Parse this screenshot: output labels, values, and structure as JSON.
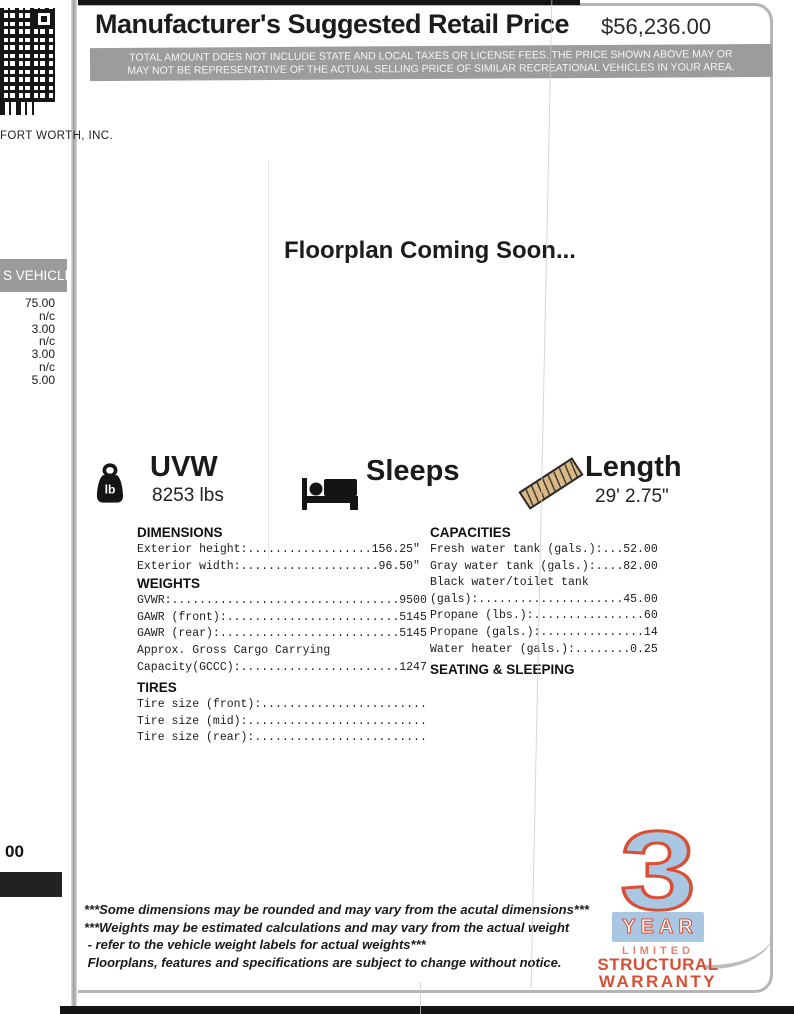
{
  "header": {
    "title": "Manufacturer's Suggested Retail Price",
    "price": "$56,236.00",
    "disclaimer": "TOTAL AMOUNT DOES NOT INCLUDE STATE AND LOCAL TAXES OR LICENSE FEES. THE PRICE SHOWN ABOVE MAY OR MAY NOT BE REPRESENTATIVE OF  THE ACTUAL SELLING PRICE OF SIMILAR RECREATIONAL VEHICLES IN YOUR AREA."
  },
  "side": {
    "dealer": "FORT WORTH, INC.",
    "banner": "S VEHICLE",
    "price_items": [
      "75.00",
      "n/c",
      "3.00",
      "n/c",
      "3.00",
      "n/c",
      "5.00"
    ],
    "partial_total": "00"
  },
  "floorplan_notice": "Floorplan Coming Soon...",
  "highlights": {
    "weight_unit": "lb",
    "uvw": {
      "label": "UVW",
      "value": "8253 lbs"
    },
    "sleeps": {
      "label": "Sleeps",
      "value": ""
    },
    "length": {
      "label": "Length",
      "value": "29' 2.75\""
    }
  },
  "specs": {
    "dimensions": {
      "heading": "DIMENSIONS",
      "lines": [
        "Exterior height:..................156.25\"",
        "Exterior width:....................96.50\""
      ]
    },
    "weights": {
      "heading": "WEIGHTS",
      "lines": [
        "GVWR:.................................9500",
        "GAWR (front):.........................5145",
        "GAWR (rear):..........................5145",
        "Approx. Gross Cargo Carrying",
        "Capacity(GCCC):.......................1247"
      ]
    },
    "tires": {
      "heading": "TIRES",
      "lines": [
        "Tire size (front):........................",
        "Tire size (mid):..........................",
        "Tire size (rear):........................."
      ]
    },
    "capacities": {
      "heading": "CAPACITIES",
      "lines": [
        "Fresh water tank (gals.):...52.00",
        "Gray water tank (gals.):....82.00",
        "Black water/toilet tank",
        "(gals):.....................45.00",
        "Propane (lbs.):................60",
        "Propane (gals.):...............14",
        "Water heater (gals.):........0.25"
      ]
    },
    "seating": {
      "heading": "SEATING & SLEEPING"
    }
  },
  "footnotes": [
    "***Some dimensions may be rounded and may vary from the acutal dimensions***",
    "***Weights may be estimated calculations and may vary from the actual weight",
    " - refer to the vehicle weight labels for actual weights***",
    " Floorplans, features and specifications are subject to change without notice."
  ],
  "warranty": {
    "number": "3",
    "year": "YEAR",
    "limited": "LIMITED",
    "structural": "STRUCTURAL",
    "warranty": "WARRANTY"
  },
  "colors": {
    "warranty_blue": "#a9c6e2",
    "warranty_red": "#d94f33",
    "disclaimer_band": "#9c9c9c",
    "ruler_tan": "#d9b886"
  }
}
